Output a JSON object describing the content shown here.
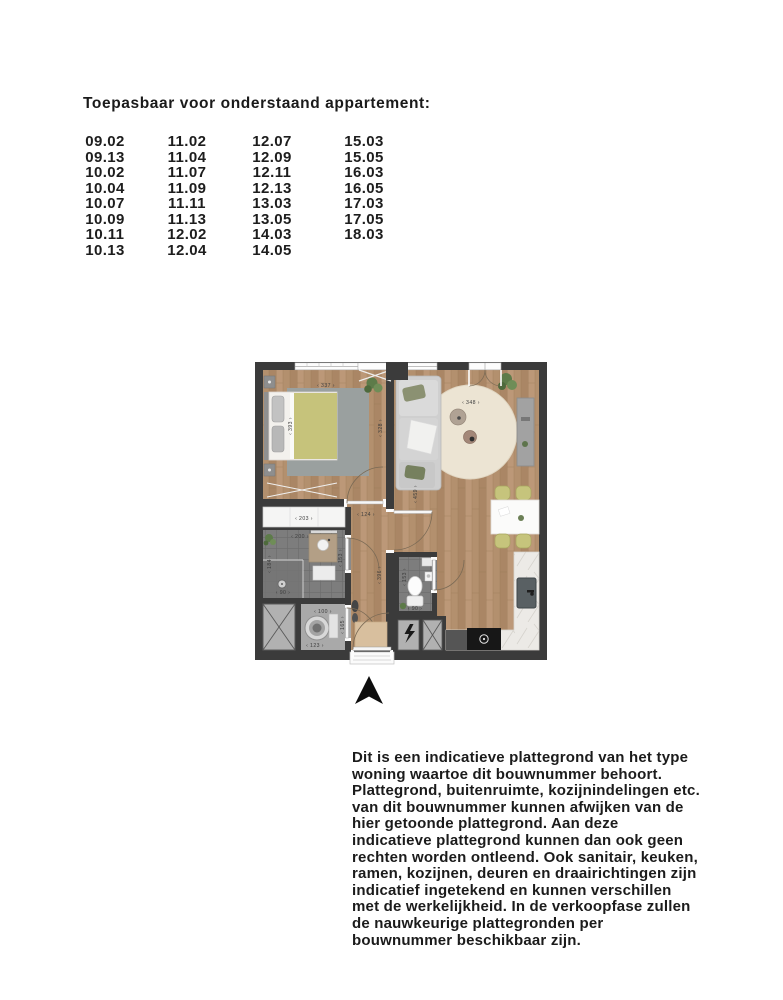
{
  "header": {
    "title": "Toepasbaar voor onderstaand appartement:"
  },
  "apartment_list": {
    "columns": [
      {
        "items": [
          "09.02",
          "09.13",
          "10.02",
          "10.04",
          "10.07",
          "10.09",
          "10.11",
          "10.13"
        ]
      },
      {
        "items": [
          "11.02",
          "11.04",
          "11.07",
          "11.09",
          "11.11",
          "11.13",
          "12.02",
          "12.04"
        ]
      },
      {
        "items": [
          "12.07",
          "12.09",
          "12.11",
          "12.13",
          "13.03",
          "13.05",
          "14.03",
          "14.05"
        ]
      },
      {
        "items": [
          "15.03",
          "15.05",
          "16.03",
          "16.05",
          "17.03",
          "17.05",
          "18.03"
        ]
      }
    ]
  },
  "floorplan": {
    "dimensions": {
      "bedroom_width": "‹ 337 ›",
      "bedroom_depth": "‹ 393 ›",
      "bedroom_side": "‹ 328 ›",
      "living_width": "‹ 348 ›",
      "living_depth": "‹ 459 ›",
      "wardrobe_width": "‹ 203 ›",
      "bathroom_width": "‹ 200 ›",
      "bathroom_depth": "‹ 184 ›",
      "shower_width": "‹ 90 ›",
      "bathroom_side": "‹ 153 ›",
      "hall_width": "‹ 124 ›",
      "hall_depth": "‹ 396 ›",
      "laundry_width": "‹ 100 ›",
      "laundry_depth": "‹ 165 ›",
      "laundry_bottom": "‹ 123 ›",
      "toilet_depth": "‹ 153 ›",
      "toilet_width": "‹ 90 ›"
    },
    "colors": {
      "wall": "#3b3b3b",
      "wood_floor": "#b3906e",
      "tile_floor": "#7d7d7d",
      "laundry_floor": "#a9a9a9",
      "blanket_green": "#c6c37b",
      "rug_gray": "#9aa09f",
      "rug_cream": "#ece4d3",
      "chair_green": "#c6c47c",
      "doormat": "#d8bf9e"
    }
  },
  "disclaimer": {
    "lines": [
      "Dit is een indicatieve plattegrond van het type",
      "woning waartoe dit bouwnummer behoort.",
      "Plattegrond, buitenruimte, kozijnindelingen etc.",
      "van dit bouwnummer kunnen afwijken van de",
      "hier getoonde plattegrond. Aan deze",
      "indicatieve plattegrond kunnen dan ook geen",
      "rechten worden ontleend. Ook sanitair, keuken,",
      "ramen, kozijnen, deuren en draairichtingen zijn",
      "indicatief ingetekend en kunnen verschillen",
      "met de werkelijkheid. In de verkoopfase zullen",
      "de nauwkeurige plattegronden per",
      "bouwnummer beschikbaar zijn."
    ]
  }
}
